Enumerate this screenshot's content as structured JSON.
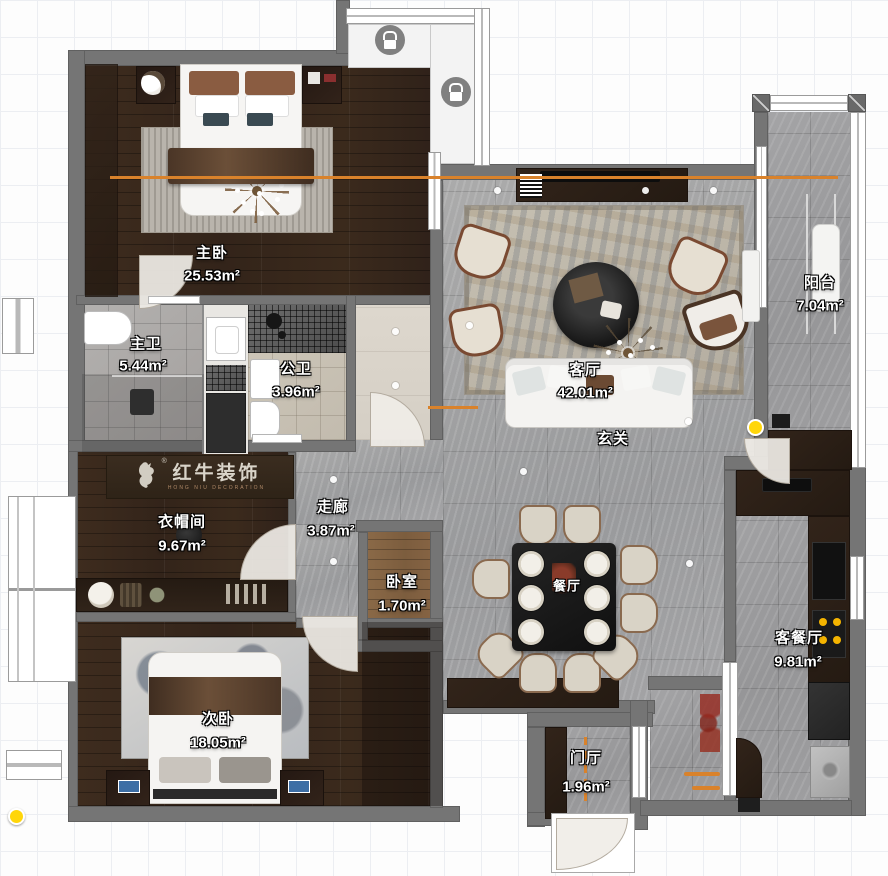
{
  "brand": {
    "name": "红牛装饰",
    "tagline": "HONG NIU DECORATION"
  },
  "rooms": {
    "master_bedroom": {
      "name": "主卧",
      "area": "25.53m²"
    },
    "master_bath": {
      "name": "主卫",
      "area": "5.44m²"
    },
    "public_bath": {
      "name": "公卫",
      "area": "3.96m²"
    },
    "living_room": {
      "name": "客厅",
      "area": "42.01m²"
    },
    "entry_hall": {
      "name": "玄关",
      "area": ""
    },
    "balcony": {
      "name": "阳台",
      "area": "7.04m²"
    },
    "cloakroom": {
      "name": "衣帽间",
      "area": "9.67m²"
    },
    "corridor": {
      "name": "走廊",
      "area": "3.87m²"
    },
    "small_bedroom": {
      "name": "卧室",
      "area": "1.70m²"
    },
    "dining_room": {
      "name": "餐厅",
      "area": ""
    },
    "kitchen_dining": {
      "name": "客餐厅",
      "area": "9.81m²"
    },
    "second_bedroom": {
      "name": "次卧",
      "area": "18.05m²"
    },
    "foyer": {
      "name": "门厅",
      "area": "1.96m²"
    }
  },
  "markers": {
    "locked_area_icons": 2,
    "camera_markers": 2
  },
  "colors": {
    "wall": "#757575",
    "reference_line": "#d9822b",
    "marker_yellow": "#ffd60a"
  }
}
